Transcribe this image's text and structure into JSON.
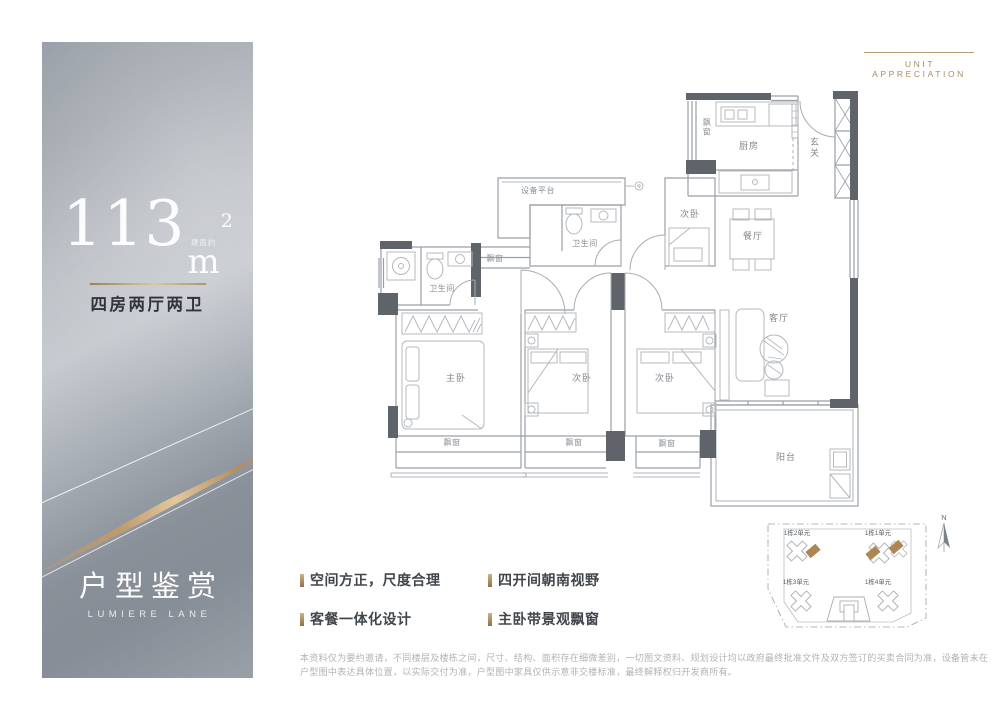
{
  "header": {
    "label": "UNIT APPRECIATION"
  },
  "panel": {
    "area_value": "113",
    "area_prefix": "建面约",
    "area_unit": "m",
    "area_sup": "2",
    "spec": "四房两厅两卫",
    "title": "户型鉴赏",
    "subtitle": "LUMIERE LANE"
  },
  "features": [
    "空间方正，尺度合理",
    "四开间朝南视野",
    "客餐一体化设计",
    "主卧带景观飘窗"
  ],
  "floorplan": {
    "labels": [
      {
        "t": "设备平台",
        "x": 160,
        "y": 110,
        "s": true
      },
      {
        "t": "卫生间",
        "x": 207,
        "y": 163,
        "s": true
      },
      {
        "t": "卫生间",
        "x": 64,
        "y": 208,
        "s": true
      },
      {
        "t": "飘窗",
        "x": 117,
        "y": 178,
        "s": true
      },
      {
        "t": "次卧",
        "x": 312,
        "y": 134
      },
      {
        "t": "厨房",
        "x": 371,
        "y": 66
      },
      {
        "t": "飘窗",
        "x": 329,
        "y": 42,
        "v": true,
        "s": true
      },
      {
        "t": "玄关",
        "x": 437,
        "y": 62,
        "v": true
      },
      {
        "t": "餐厅",
        "x": 375,
        "y": 156
      },
      {
        "t": "客厅",
        "x": 401,
        "y": 238
      },
      {
        "t": "主卧",
        "x": 78,
        "y": 298
      },
      {
        "t": "次卧",
        "x": 204,
        "y": 298
      },
      {
        "t": "次卧",
        "x": 287,
        "y": 298
      },
      {
        "t": "阳台",
        "x": 408,
        "y": 377
      },
      {
        "t": "飘窗",
        "x": 74,
        "y": 362,
        "s": true
      },
      {
        "t": "飘窗",
        "x": 196,
        "y": 362,
        "s": true
      },
      {
        "t": "飘窗",
        "x": 289,
        "y": 363,
        "s": true
      }
    ]
  },
  "siteplan": {
    "north_label": "N",
    "units": [
      "1栋2单元",
      "1栋1单元",
      "1栋3单元",
      "1栋4单元"
    ]
  },
  "disclaimer": "本资料仅为要约邀请，不同楼层及楼栋之间，尺寸、结构、面积存在细微差别，一切图文资料、规划设计均以政府最终批准文件及双方签订的买卖合同为准，设备管未在户型图中表达具体位置，以实际交付为准，户型图中家具仅供示意非交楼标准，最终解释权归开发商所有。",
  "colors": {
    "gold_accent": "#b3946a",
    "wall_dark": "#5f646a",
    "unit_highlight": "#ad8752"
  }
}
